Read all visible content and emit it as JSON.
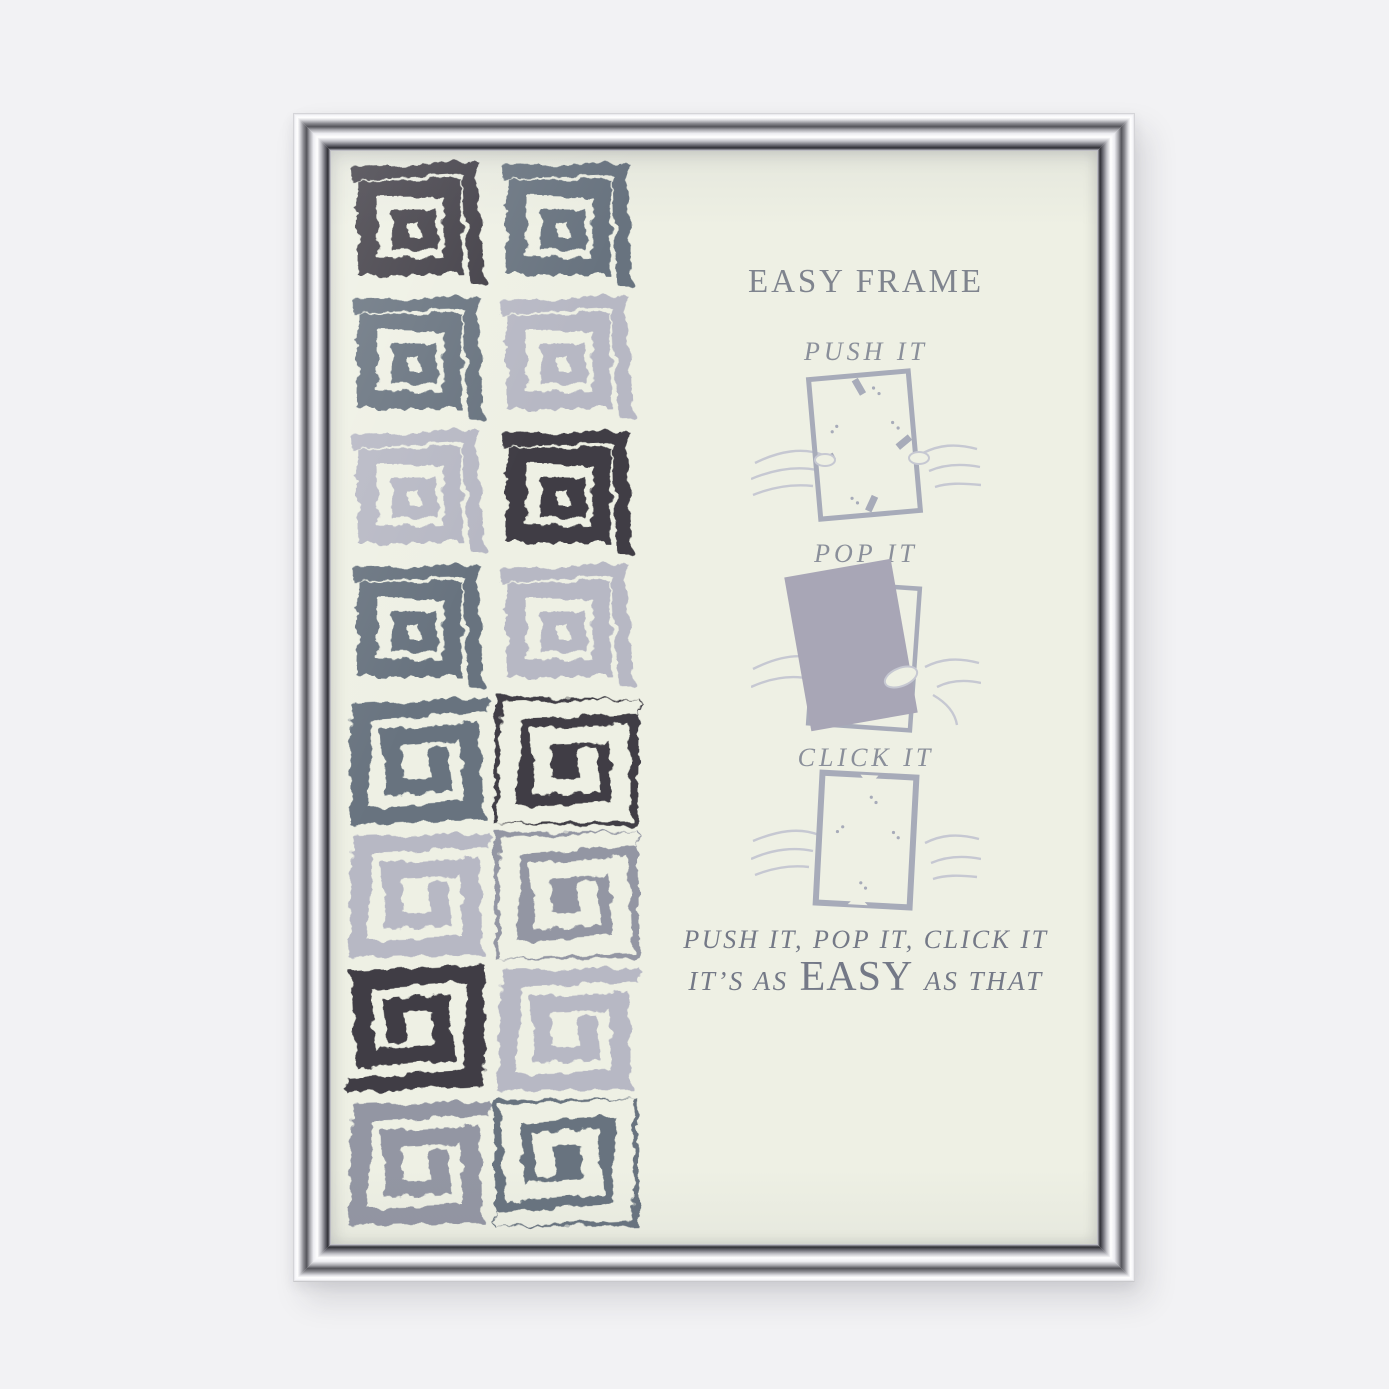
{
  "scene": {
    "title": "EASY FRAME",
    "steps": [
      {
        "label": "PUSH IT"
      },
      {
        "label": "POP IT"
      },
      {
        "label": "CLICK IT"
      }
    ],
    "footer_line1": "PUSH IT, POP IT, CLICK IT",
    "footer_line2_prefix": "IT’S AS",
    "footer_line2_emphasis": "EASY",
    "footer_line2_suffix": "AS THAT"
  },
  "colors": {
    "backdrop": "#f2f2f4",
    "paper": "#eef0e4",
    "ink_title": "#7f848e",
    "ink_step": "#8a8f9a",
    "ink_footer": "#747987",
    "illustration_line": "#a7abb9",
    "illustration_hand": "#c6c8d2",
    "pop_panel": "#a8a6b6",
    "pattern_dark": "#3f3d45",
    "pattern_slate": "#67737f",
    "pattern_gray": "#9396a3",
    "pattern_light": "#b7b8c4"
  },
  "pattern": {
    "grid": [
      [
        {
          "motif": "squares",
          "color": "dark"
        },
        {
          "motif": "squares",
          "color": "slate"
        }
      ],
      [
        {
          "motif": "squares",
          "color": "slate"
        },
        {
          "motif": "squares",
          "color": "light"
        }
      ],
      [
        {
          "motif": "squares",
          "color": "light"
        },
        {
          "motif": "squares",
          "color": "dark"
        }
      ],
      [
        {
          "motif": "squares",
          "color": "slate"
        },
        {
          "motif": "squares",
          "color": "light"
        }
      ],
      [
        {
          "motif": "spiral",
          "color": "slate"
        },
        {
          "motif": "spiral",
          "color": "dark",
          "inverted": true
        }
      ],
      [
        {
          "motif": "spiral",
          "color": "light"
        },
        {
          "motif": "spiral",
          "color": "gray",
          "inverted": true
        }
      ],
      [
        {
          "motif": "spiral",
          "color": "dark",
          "rot": 180
        },
        {
          "motif": "spiral",
          "color": "light"
        }
      ],
      [
        {
          "motif": "spiral",
          "color": "gray"
        },
        {
          "motif": "spiral",
          "color": "slate",
          "inverted": true,
          "rot": 180
        }
      ]
    ]
  }
}
